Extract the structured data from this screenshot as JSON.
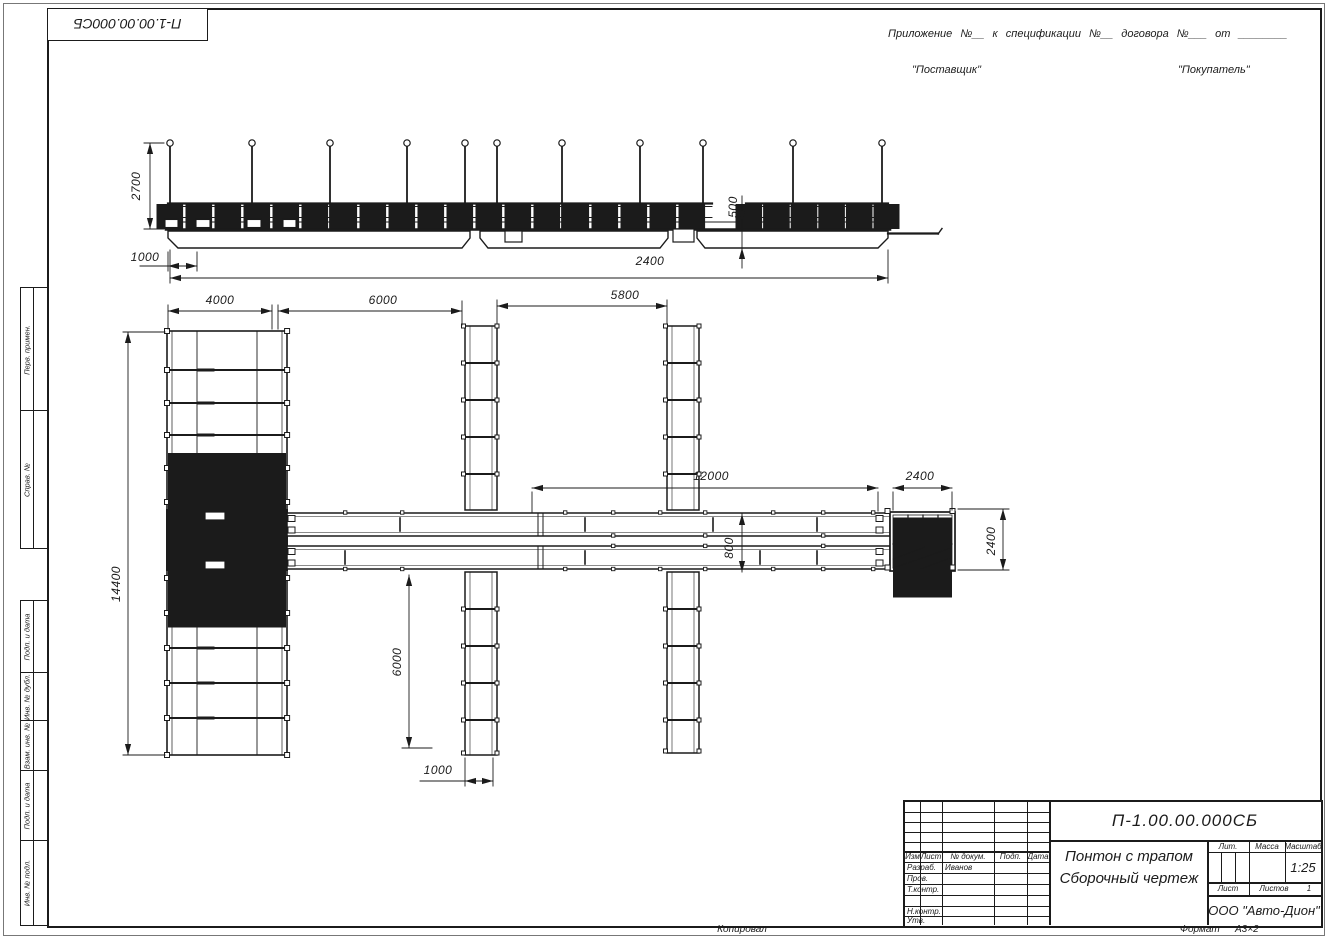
{
  "colors": {
    "ink": "#1b1b1b",
    "paper": "#ffffff"
  },
  "stamp": {
    "doc_number": "П-1.00.00.000СБ"
  },
  "header": {
    "appendix_line": "Приложение №__    к спецификации №__   договора №___  от ________",
    "supplier": "\"Поставщик\"",
    "buyer": "\"Покупатель\""
  },
  "frame": {
    "left_labels": [
      "Перв. примен.",
      "Справ. №",
      "Подп. и дата",
      "Инв. № дубл.",
      "Взам. инв. №",
      "Подп. и дата",
      "Инв. № подл."
    ]
  },
  "title_block": {
    "doc_number": "П-1.00.00.000СБ",
    "product_title": "Понтон с трапом",
    "doc_type": "Сборочный чертеж",
    "company": "ООО \"Авто-Дион\"",
    "columns": [
      "Изм",
      "Лист",
      "№ докум.",
      "Подп.",
      "Дата"
    ],
    "rows": {
      "developed_label": "Разраб.",
      "developed_name": "Иванов",
      "checked_label": "Пров.",
      "tcontrol_label": "Т.контр.",
      "ncontrol_label": "Н.контр.",
      "approved_label": "Утв."
    },
    "lit_label": "Лит.",
    "mass_label": "Масса",
    "scale_label": "Масштаб",
    "scale_value": "1:25",
    "sheet_label": "Лист",
    "sheets_label": "Листов",
    "sheets_value": "1"
  },
  "footer": {
    "copied": "Копировал",
    "format_label": "Формат",
    "format_value": "А3×2"
  },
  "dimensions": {
    "side_pole_height": "2700",
    "side_ramp_offset": "1000",
    "side_freeboard": "500",
    "side_length": "2400",
    "plan_seg1": "4000",
    "plan_seg2": "6000",
    "plan_seg3": "5800",
    "plan_walkway": "12000",
    "plan_end_platform": "2400",
    "plan_walkway_gap": "800",
    "plan_pier_length": "6000",
    "plan_pier_width": "1000",
    "plan_overall_width": "14400",
    "plan_end_width": "2400"
  }
}
